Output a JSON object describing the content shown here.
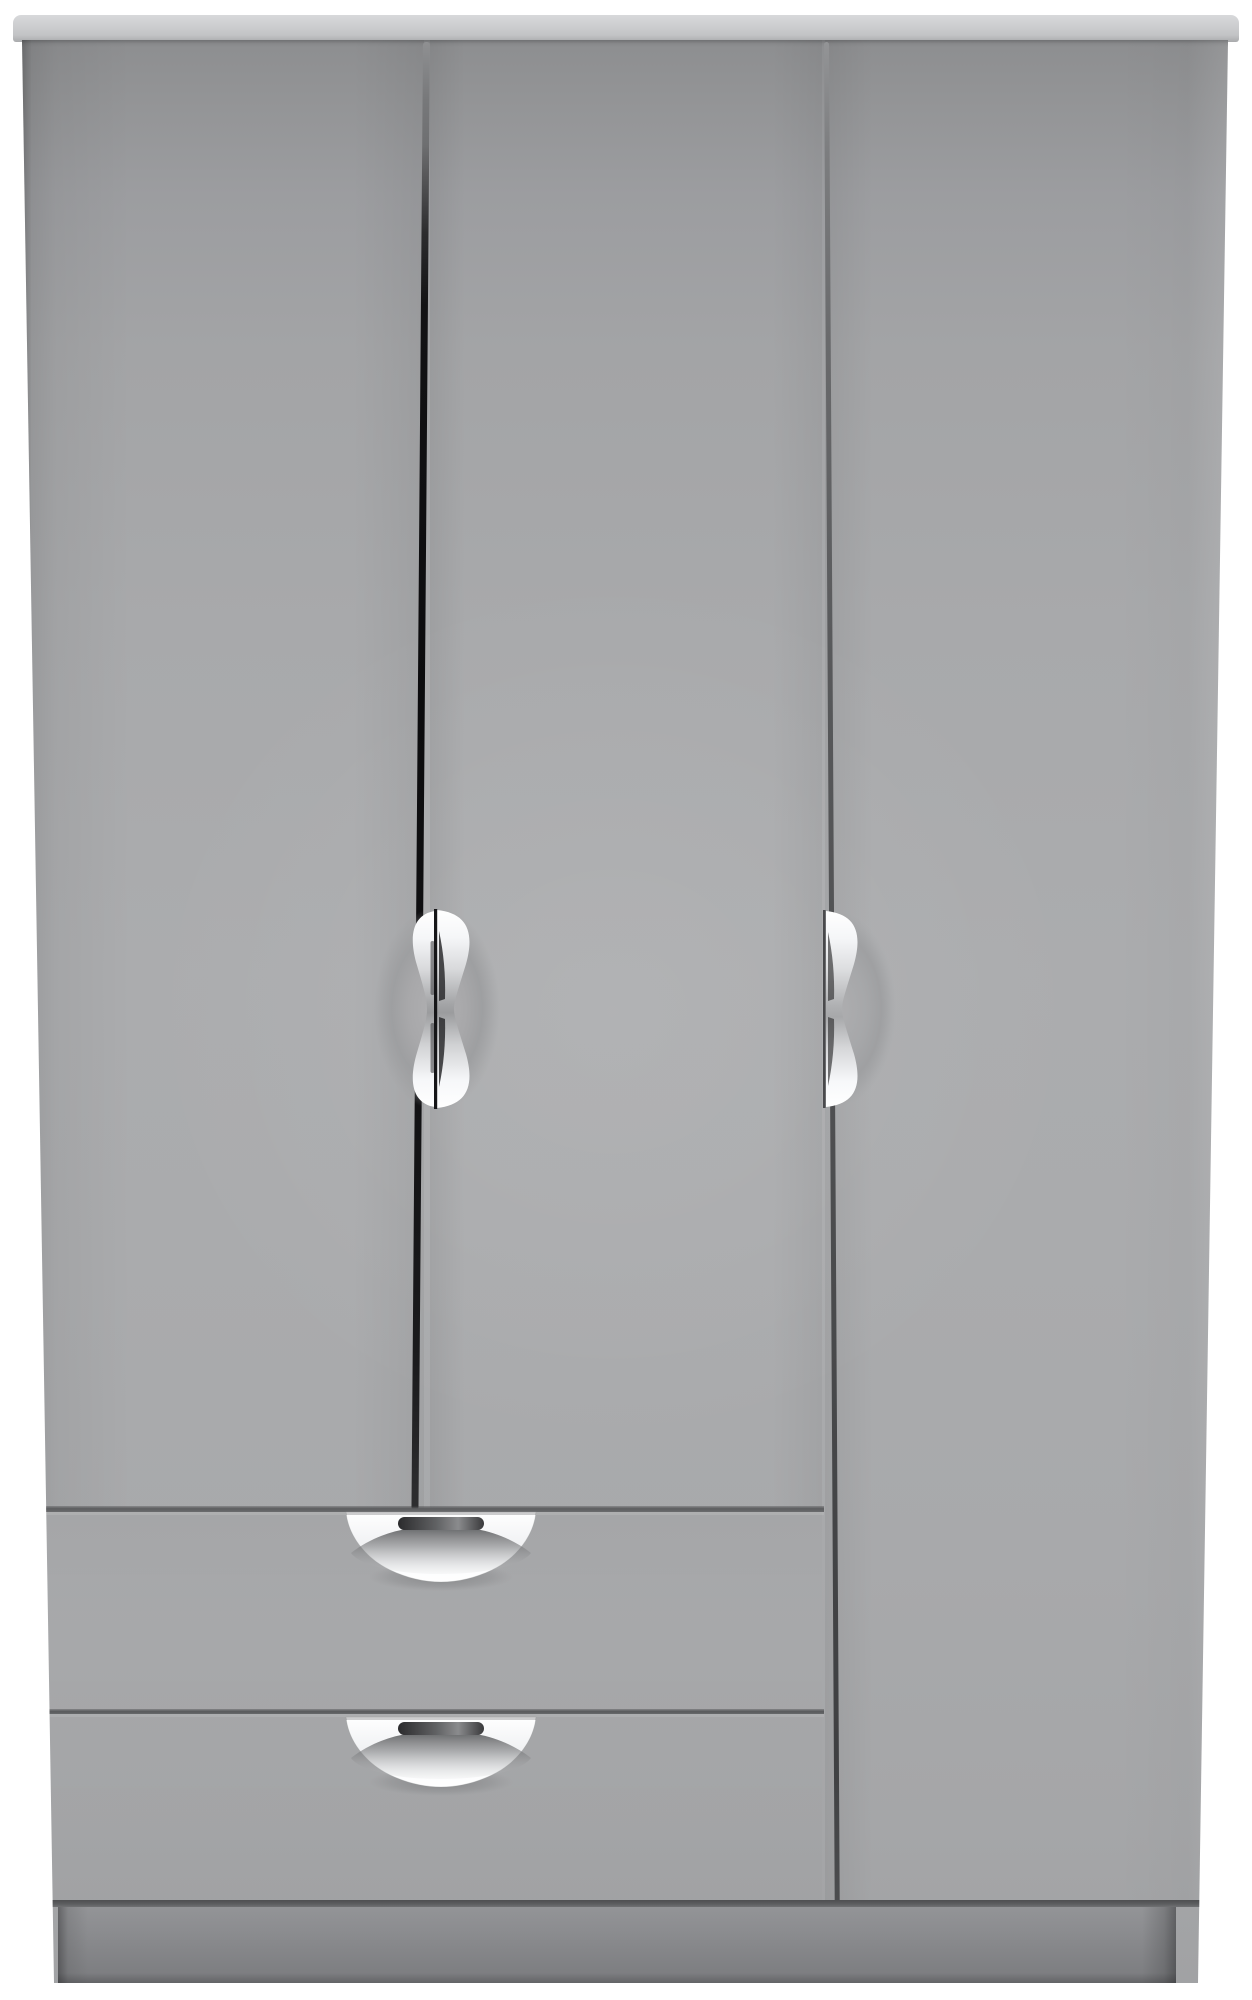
{
  "scene": {
    "type": "product-photo",
    "background_color": "#ffffff",
    "subject": "Grey three-door wardrobe with two drawers and polished chrome cup handles, viewed straight on"
  },
  "wardrobe": {
    "cornice": {
      "part": "top cornice board",
      "color_top": "#d8d9db",
      "color_bottom": "#a9aaac"
    },
    "body": {
      "color_main": "#a8a9ab",
      "color_top_shade": "#8d8e90",
      "color_bottom_shade": "#a1a2a4"
    },
    "doors": [
      {
        "id": "left-door",
        "handle": "vertical chrome cup on right edge"
      },
      {
        "id": "middle-door",
        "handle": "vertical chrome cup on left edge"
      },
      {
        "id": "right-door",
        "handle": "vertical chrome cup on left edge",
        "full_height": true
      }
    ],
    "drawers": [
      {
        "id": "top-drawer",
        "handle": "horizontal chrome cup at top centre"
      },
      {
        "id": "bottom-drawer",
        "handle": "horizontal chrome cup at top centre"
      }
    ],
    "gaps": {
      "center_gap_color": "#0c0c0e",
      "right_gap_color": "#4e4f51"
    },
    "plinth": {
      "part": "kickboard",
      "color": "#85868a"
    },
    "handle_finish": {
      "chrome_light": "#ffffff",
      "chrome_mid": "#9b9c9e",
      "recess_dark": "#2c2c2e"
    }
  }
}
